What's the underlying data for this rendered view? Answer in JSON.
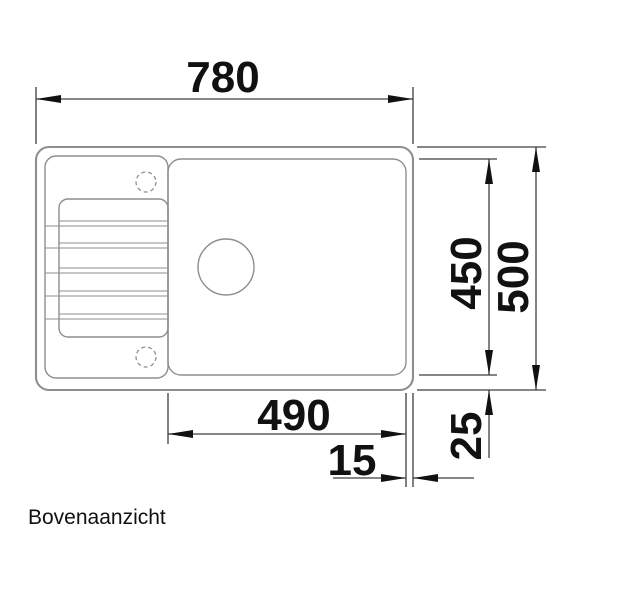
{
  "drawing": {
    "caption": "Bovenaanzicht",
    "dimensions": {
      "overall_width": "780",
      "overall_depth": "500",
      "bowl_depth": "450",
      "bowl_width": "490",
      "right_rim_offset": "15",
      "bottom_rim_offset": "25"
    },
    "colors": {
      "sink_outline": "#8e8e8e",
      "dimension_lines": "#3f3f3f",
      "ink": "#111111",
      "background": "#ffffff"
    }
  }
}
